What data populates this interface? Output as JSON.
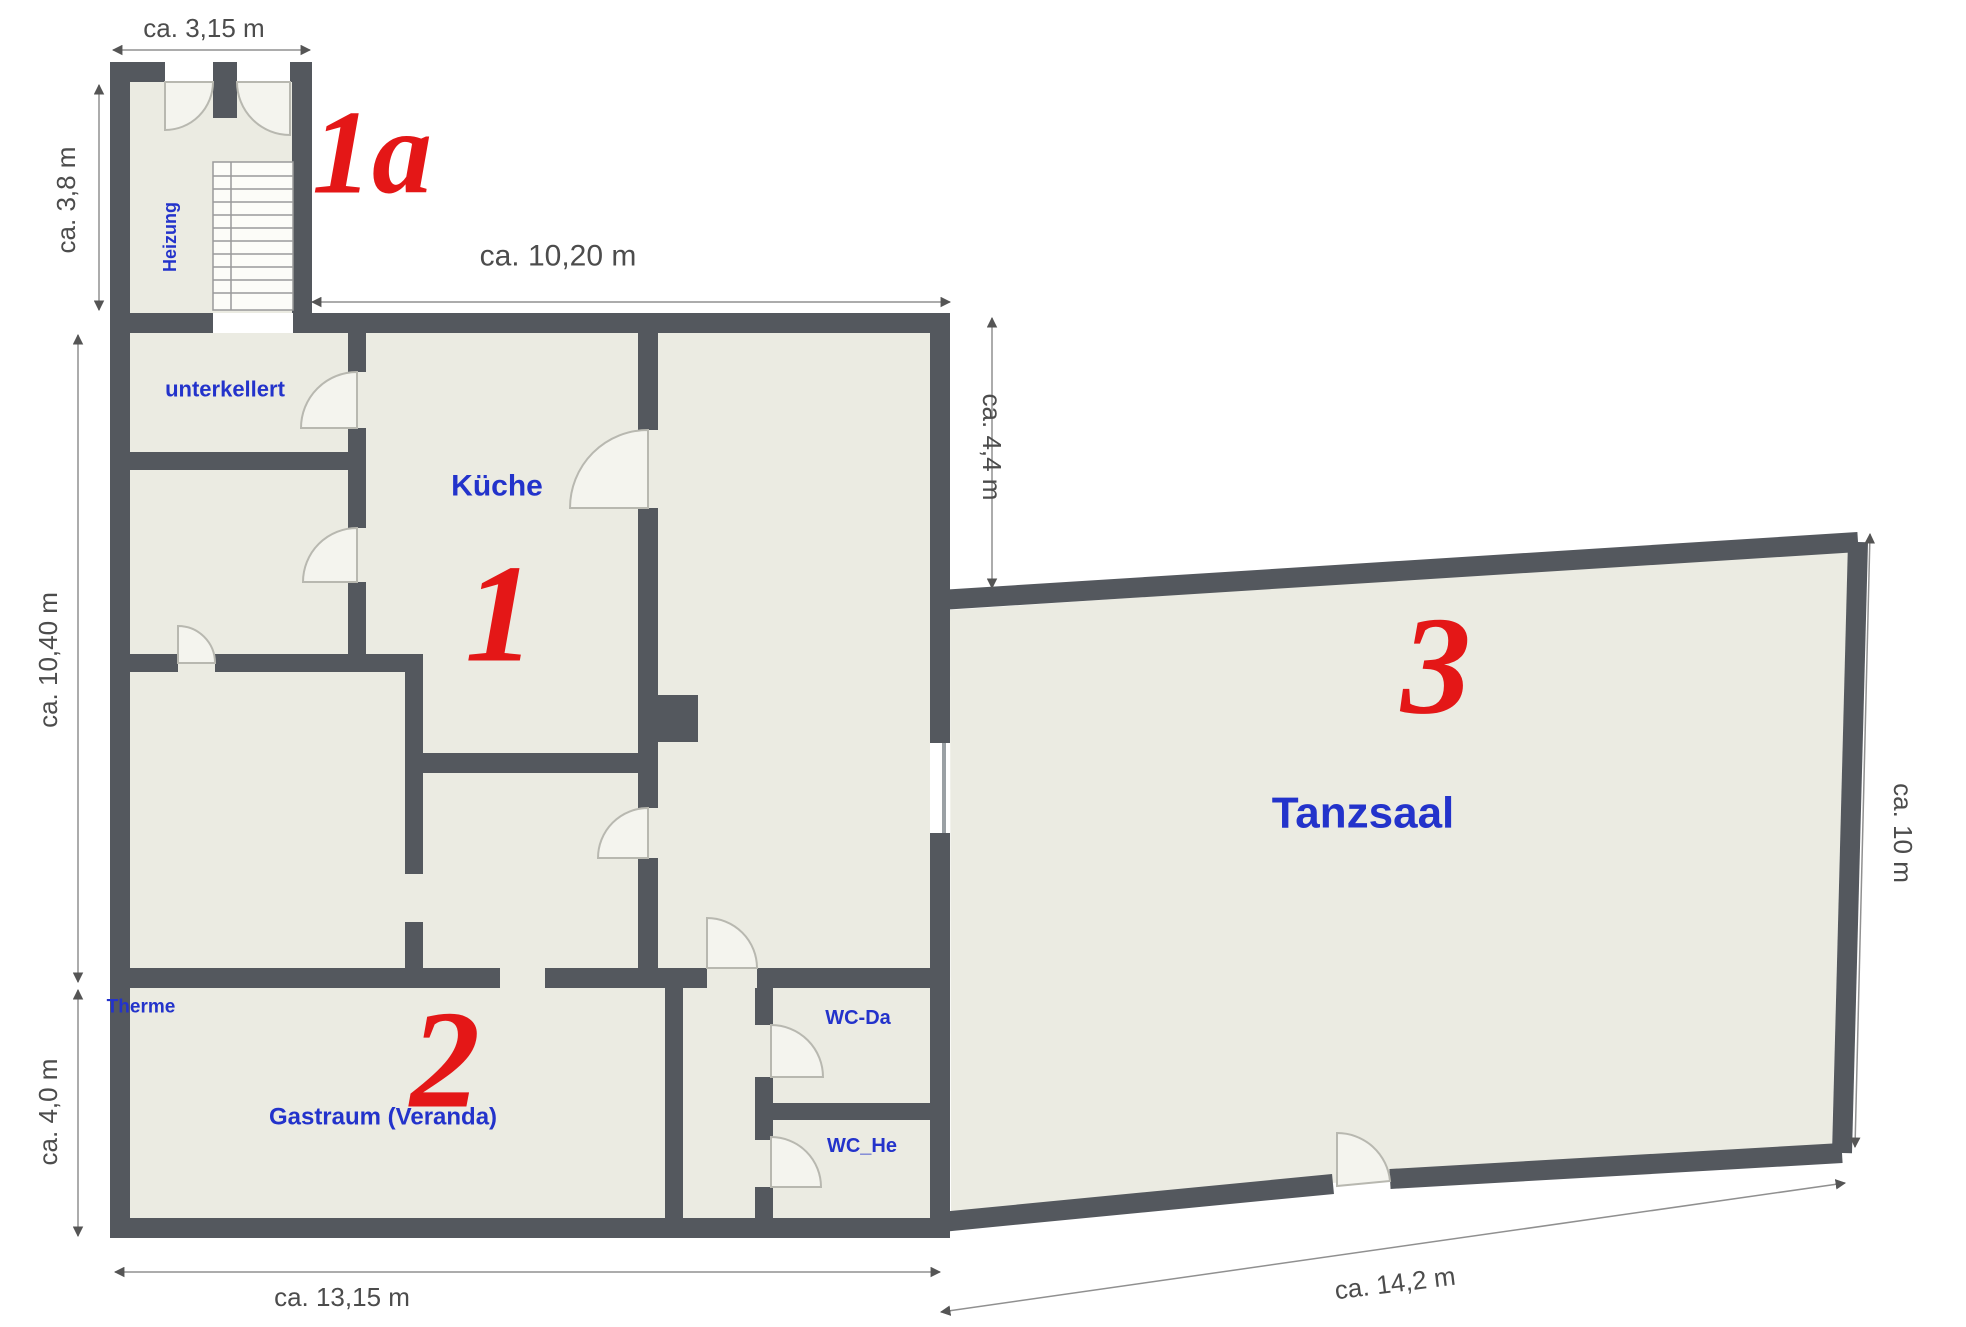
{
  "colors": {
    "background": "#ffffff",
    "wall": "#54585e",
    "room_fill": "#ebebe2",
    "label_blue": "#2333cb",
    "section_red": "#e41717",
    "dim_text": "#4c4c4c",
    "dim_line": "#909090",
    "door_fill": "#f4f4ee",
    "door_stroke": "#b8b8b0",
    "stairs_line": "#9a9a9a",
    "door_leaf": "#9aa0a4"
  },
  "sections": {
    "s1a": "1a",
    "s1": "1",
    "s2": "2",
    "s3": "3"
  },
  "rooms": {
    "heizung": "Heizung",
    "unterkellert": "unterkellert",
    "kueche": "Küche",
    "therme": "Therme",
    "gastraum": "Gastraum (Veranda)",
    "wc_da": "WC-Da",
    "wc_he": "WC_He",
    "tanzsaal": "Tanzsaal"
  },
  "dimensions": {
    "annex_width": "ca. 3,15 m",
    "annex_height": "ca. 3,8 m",
    "main_top": "ca. 10,20 m",
    "offset_right": "ca. 4,4 m",
    "left_upper": "ca. 10,40 m",
    "left_lower": "ca. 4,0 m",
    "main_bottom": "ca. 13,15 m",
    "hall_bottom": "ca. 14,2 m",
    "hall_right": "ca. 10 m"
  }
}
